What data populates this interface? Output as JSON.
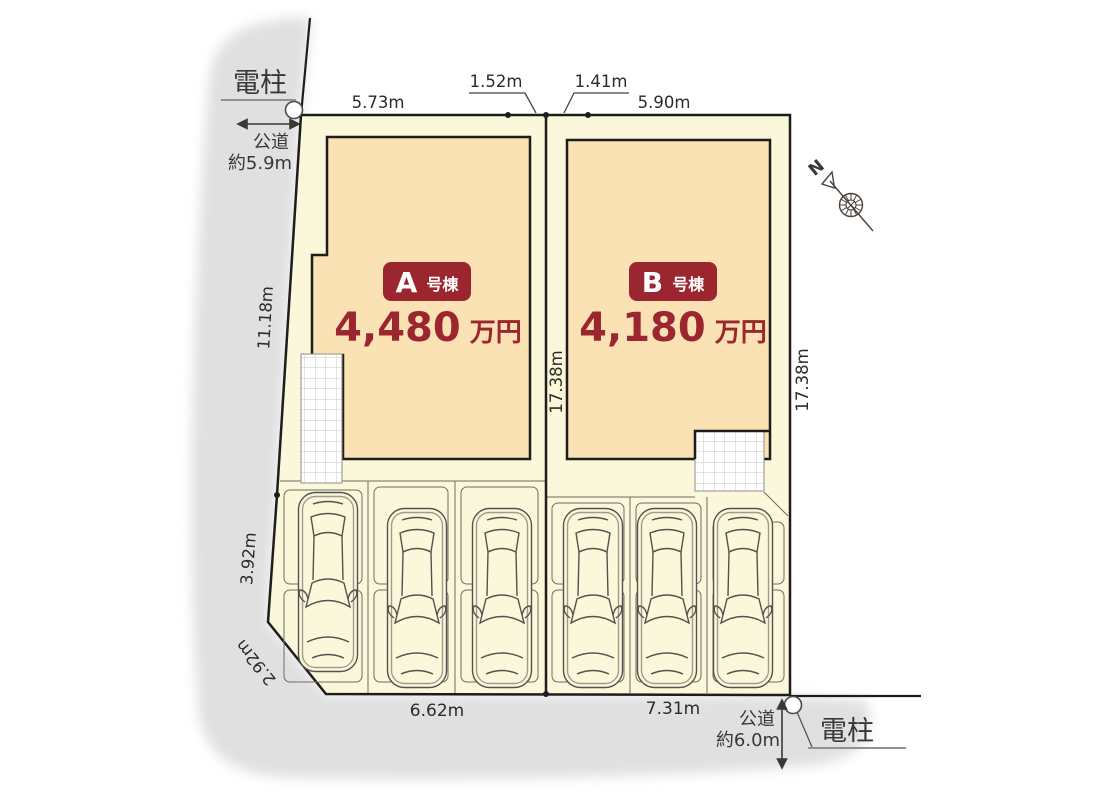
{
  "plan": {
    "title": "site-plan-two-lots",
    "poles": {
      "top_label": "電柱",
      "bottom_label": "電柱"
    },
    "roads": {
      "left": {
        "name": "公道",
        "width": "約5.9m"
      },
      "bottom": {
        "name": "公道",
        "width": "約6.0m"
      }
    },
    "dimensions": {
      "top_a": "5.73m",
      "top_gap_a": "1.52m",
      "top_gap_b": "1.41m",
      "top_b": "5.90m",
      "left_upper": "11.18m",
      "left_lower": "3.92m",
      "corner": "2.92m",
      "center_depth": "17.38m",
      "right_depth": "17.38m",
      "bottom_a": "6.62m",
      "bottom_b": "7.31m"
    },
    "compass": {
      "north_label": "N"
    },
    "lots": [
      {
        "id": "A",
        "badge_letter": "A",
        "badge_suffix": "号棟",
        "price_number": "4,480",
        "price_unit": "万円"
      },
      {
        "id": "B",
        "badge_letter": "B",
        "badge_suffix": "号棟",
        "price_number": "4,180",
        "price_unit": "万円"
      }
    ],
    "colors": {
      "accent_red": "#9b2630",
      "lot_fill": "#fbf7da",
      "building_fill": "#fae2b4",
      "shadow_gray": "#e0e0e0",
      "line_dark": "#1d1d1d"
    }
  }
}
